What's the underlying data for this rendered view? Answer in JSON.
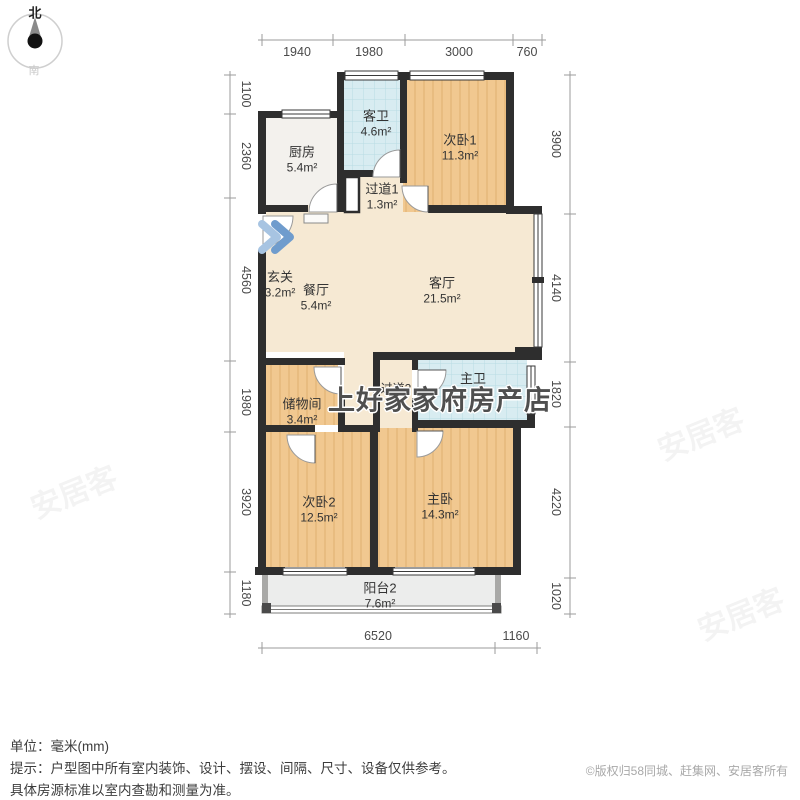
{
  "compass": {
    "north": "北",
    "south": "南"
  },
  "dimensions": {
    "top": [
      "1940",
      "1980",
      "3000",
      "760"
    ],
    "left": [
      "1100",
      "2360",
      "4560",
      "1980",
      "3920",
      "1180"
    ],
    "right": [
      "3900",
      "4140",
      "1820",
      "4220",
      "1020"
    ],
    "bottom": [
      "6520",
      "1160"
    ]
  },
  "rooms": {
    "kitchen": {
      "name": "厨房",
      "area": "5.4m²"
    },
    "guest_bath": {
      "name": "客卫",
      "area": "4.6m²"
    },
    "bedroom1": {
      "name": "次卧1",
      "area": "11.3m²"
    },
    "hallway1": {
      "name": "过道1",
      "area": "1.3m²"
    },
    "entry": {
      "name": "玄关",
      "area": "3.2m²"
    },
    "dining": {
      "name": "餐厅",
      "area": "5.4m²"
    },
    "living": {
      "name": "客厅",
      "area": "21.5m²"
    },
    "storage": {
      "name": "储物间",
      "area": "3.4m²"
    },
    "hallway2": {
      "name": "过道2",
      "area": ""
    },
    "master_bath": {
      "name": "主卫",
      "area": ""
    },
    "bedroom2": {
      "name": "次卧2",
      "area": "12.5m²"
    },
    "master_bedroom": {
      "name": "主卧",
      "area": "14.3m²"
    },
    "balcony": {
      "name": "阳台2",
      "area": "7.6m²"
    }
  },
  "watermark": {
    "store": "上好家家府房产店",
    "site": "安居客"
  },
  "footer": {
    "unit": "单位：毫米(mm)",
    "tip_line1": "提示：户型图中所有室内装饰、设计、摆设、间隔、尺寸、设备仅供参考。",
    "tip_line2": "具体房源标准以室内查勘和测量为准。",
    "copyright": "©版权归58同城、赶集网、安居客所有"
  },
  "colors": {
    "wall": "#2e2e2e",
    "wood_floor": "#f1c890",
    "marble_floor": "#f6e9d3",
    "tile_floor": "#d8ecf1",
    "balcony_floor": "#ecedec",
    "entry_arrow": "#8fb5dc"
  }
}
